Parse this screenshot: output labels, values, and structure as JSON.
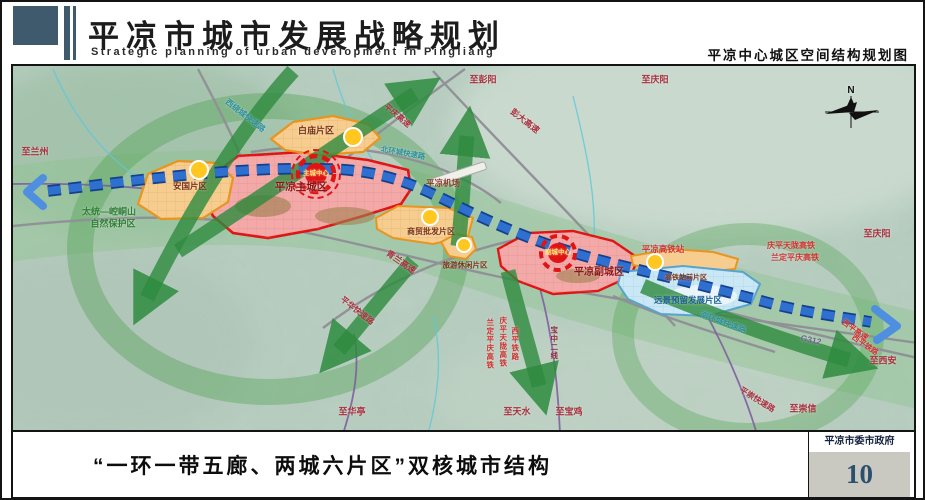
{
  "header": {
    "title": "平凉市城市发展战略规划",
    "subtitle": "Strategic planning of urban development in Pingliang",
    "map_name": "平凉中心城区空间结构规划图"
  },
  "footer": {
    "caption": "“一环一带五廊、两城六片区”双核城市结构",
    "authority": "平凉市委市政府",
    "page_number": "10"
  },
  "colors": {
    "slate": "#3f5a6d",
    "terrain": "#b9cfc2",
    "band-green": "#8cc48c",
    "ring-green": "#4da04d",
    "corridor-green": "#2e8b3e",
    "axis-blue": "#2f6fd0",
    "axis-dark": "#14408a",
    "city-fill": "#f4a9a9",
    "city-border": "#e01414",
    "district-fill": "#f6cd8f",
    "district-border": "#e8951f",
    "reserve-fill": "#c9e7f4",
    "reserve-border": "#58a3cc",
    "subcenter-yellow": "#ffc71f",
    "road-gray": "#8f8f96",
    "rail-purple": "#7f5fa0",
    "river-cyan": "#5fc8d8"
  },
  "map": {
    "compass": "N",
    "labels": [
      {
        "t": "至兰州",
        "x": 22,
        "y": 86,
        "c": "#a8303f",
        "s": 9
      },
      {
        "t": "太统—崆峒山",
        "x": 96,
        "y": 146,
        "c": "#2f7d35",
        "s": 9
      },
      {
        "t": "自然保护区",
        "x": 100,
        "y": 158,
        "c": "#2f7d35",
        "s": 9
      },
      {
        "t": "西绕城快速路",
        "x": 232,
        "y": 50,
        "c": "#2e8fa0",
        "s": 8,
        "r": 38
      },
      {
        "t": "白庙片区",
        "x": 303,
        "y": 65,
        "c": "#7a3318",
        "s": 9
      },
      {
        "t": "平庆高速",
        "x": 384,
        "y": 50,
        "c": "#a8303f",
        "s": 8,
        "r": 40
      },
      {
        "t": "北环城快速路",
        "x": 390,
        "y": 87,
        "c": "#2e8fa0",
        "s": 7.5,
        "r": 10
      },
      {
        "t": "至彭阳",
        "x": 470,
        "y": 14,
        "c": "#a8303f",
        "s": 9
      },
      {
        "t": "彭大高速",
        "x": 512,
        "y": 55,
        "c": "#a8303f",
        "s": 8.5,
        "r": 38
      },
      {
        "t": "至庆阳",
        "x": 642,
        "y": 14,
        "c": "#a8303f",
        "s": 9
      },
      {
        "t": "平凉机场",
        "x": 430,
        "y": 117,
        "c": "#8c3a2a",
        "s": 8.5
      },
      {
        "t": "平凉主城区",
        "x": 288,
        "y": 121,
        "c": "#8c1616",
        "s": 10.5
      },
      {
        "t": "主城中心",
        "x": 303,
        "y": 108,
        "c": "#ffe16e",
        "s": 6.5
      },
      {
        "t": "安国片区",
        "x": 177,
        "y": 120,
        "c": "#7a3318",
        "s": 8.5
      },
      {
        "t": "商贸批发片区",
        "x": 418,
        "y": 166,
        "c": "#7a3318",
        "s": 8
      },
      {
        "t": "青兰高速",
        "x": 388,
        "y": 196,
        "c": "#a8303f",
        "s": 8.5,
        "r": 35
      },
      {
        "t": "旅游休闲片区",
        "x": 452,
        "y": 199,
        "c": "#7a3318",
        "s": 7.5
      },
      {
        "t": "平凉副城区",
        "x": 586,
        "y": 207,
        "c": "#8c1616",
        "s": 10
      },
      {
        "t": "副城中心",
        "x": 545,
        "y": 187,
        "c": "#ffe16e",
        "s": 6.5
      },
      {
        "t": "平凉高铁站",
        "x": 650,
        "y": 183,
        "c": "#d03030",
        "s": 8.5
      },
      {
        "t": "庆平天陇高铁",
        "x": 778,
        "y": 180,
        "c": "#d03030",
        "s": 8
      },
      {
        "t": "兰定平庆高铁",
        "x": 782,
        "y": 192,
        "c": "#d03030",
        "s": 8
      },
      {
        "t": "至庆阳",
        "x": 864,
        "y": 168,
        "c": "#a8303f",
        "s": 9
      },
      {
        "t": "高铁站前片区",
        "x": 673,
        "y": 212,
        "c": "#7a3318",
        "s": 7
      },
      {
        "t": "远景预留发展片区",
        "x": 675,
        "y": 234,
        "c": "#1a6090",
        "s": 8.5
      },
      {
        "t": "南环城快速路",
        "x": 710,
        "y": 257,
        "c": "#2e8fa0",
        "s": 8,
        "r": 20
      },
      {
        "t": "G312",
        "x": 798,
        "y": 274,
        "c": "#6f5f8f",
        "s": 8.5,
        "r": 12
      },
      {
        "t": "西平高速",
        "x": 842,
        "y": 264,
        "c": "#d03030",
        "s": 7.5,
        "r": 35
      },
      {
        "t": "西平铁路",
        "x": 852,
        "y": 279,
        "c": "#d03030",
        "s": 7.5,
        "r": 35
      },
      {
        "t": "至西安",
        "x": 870,
        "y": 295,
        "c": "#a8303f",
        "s": 9
      },
      {
        "t": "至崇信",
        "x": 790,
        "y": 343,
        "c": "#a8303f",
        "s": 9
      },
      {
        "t": "平崇快速路",
        "x": 744,
        "y": 334,
        "c": "#a8303f",
        "s": 8,
        "r": 32
      },
      {
        "t": "平华快速路",
        "x": 344,
        "y": 245,
        "c": "#a8303f",
        "s": 8,
        "r": 38
      },
      {
        "t": "兰定平庆高铁",
        "x": 477,
        "y": 278,
        "c": "#d03030",
        "s": 7.5,
        "v": 1
      },
      {
        "t": "庆平天陇高铁",
        "x": 490,
        "y": 276,
        "c": "#d03030",
        "s": 7.5,
        "v": 1
      },
      {
        "t": "西平铁路",
        "x": 502,
        "y": 278,
        "c": "#d03030",
        "s": 7.5,
        "v": 1
      },
      {
        "t": "宝中二线",
        "x": 541,
        "y": 277,
        "c": "#8a2838",
        "s": 7.5,
        "v": 1
      },
      {
        "t": "至华亭",
        "x": 339,
        "y": 346,
        "c": "#a8303f",
        "s": 9
      },
      {
        "t": "至天水",
        "x": 504,
        "y": 346,
        "c": "#a8303f",
        "s": 9
      },
      {
        "t": "至宝鸡",
        "x": 556,
        "y": 346,
        "c": "#a8303f",
        "s": 9
      },
      {
        "t": "N",
        "x": 838,
        "y": 25,
        "c": "#111111",
        "s": 10
      }
    ]
  }
}
